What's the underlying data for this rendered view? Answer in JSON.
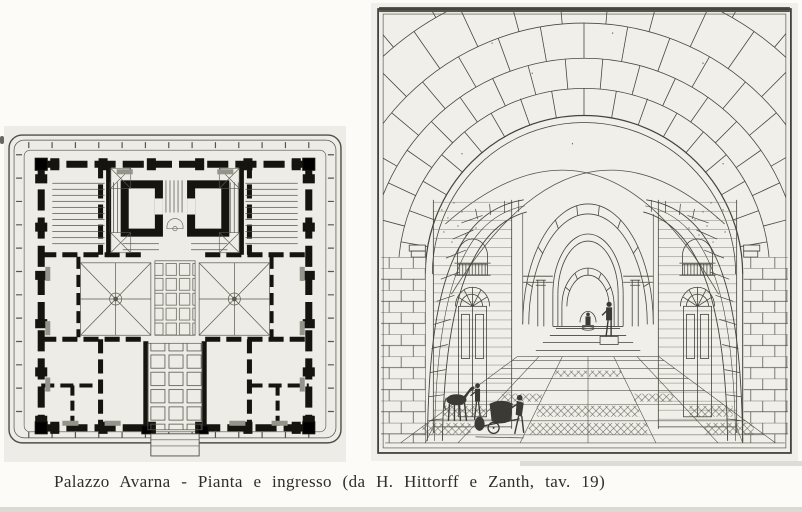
{
  "page": {
    "background_color": "#fcfbf7",
    "bottom_edge_color": "#dbd9d3"
  },
  "caption": {
    "text": "Palazzo Avarna - Pianta e ingresso (da H. Hittorff e Zanth, tav. 19)"
  },
  "figures": {
    "plan": {
      "paper_color": "#edece6",
      "ink_color": "#15140f"
    },
    "entrance": {
      "paper_color": "#f0efe9",
      "ink_color": "#4a4940"
    }
  }
}
